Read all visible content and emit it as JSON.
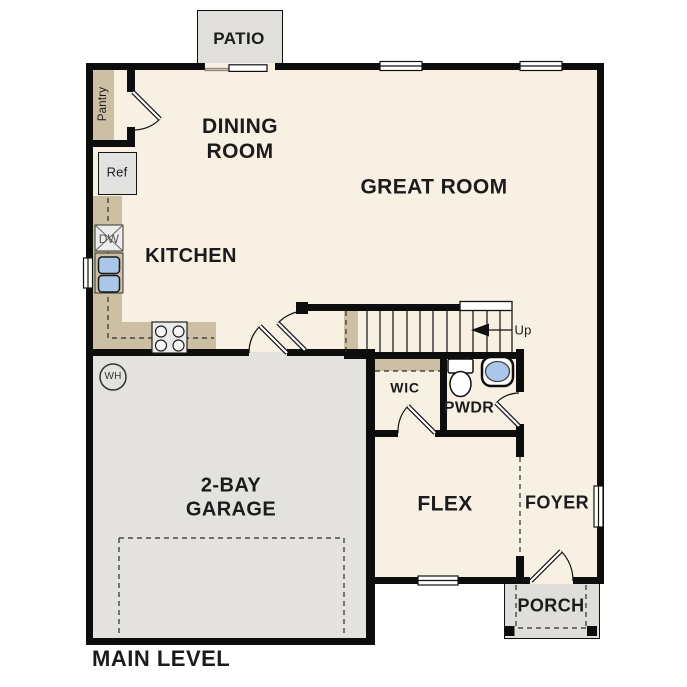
{
  "plan_title": "MAIN LEVEL",
  "rooms": {
    "patio": "PATIO",
    "dining_room": "DINING\nROOM",
    "great_room": "GREAT ROOM",
    "kitchen": "KITCHEN",
    "garage": "2-BAY\nGARAGE",
    "wic": "WIC",
    "powder_room": "PWDR",
    "flex": "FLEX",
    "foyer": "FOYER",
    "porch": "PORCH"
  },
  "fixtures": {
    "pantry": "Pantry",
    "refrigerator": "Ref",
    "dishwasher": "DW",
    "water_heater": "WH",
    "stairs_direction": "Up"
  },
  "colors": {
    "wall": "#0d0d0d",
    "floor": "#f8f0e3",
    "garage_floor": "#e3e2de",
    "patio_porch_concrete": "#e0dfdc",
    "counter": "#cdbfa4",
    "sink_blue": "#a9c7e8"
  }
}
